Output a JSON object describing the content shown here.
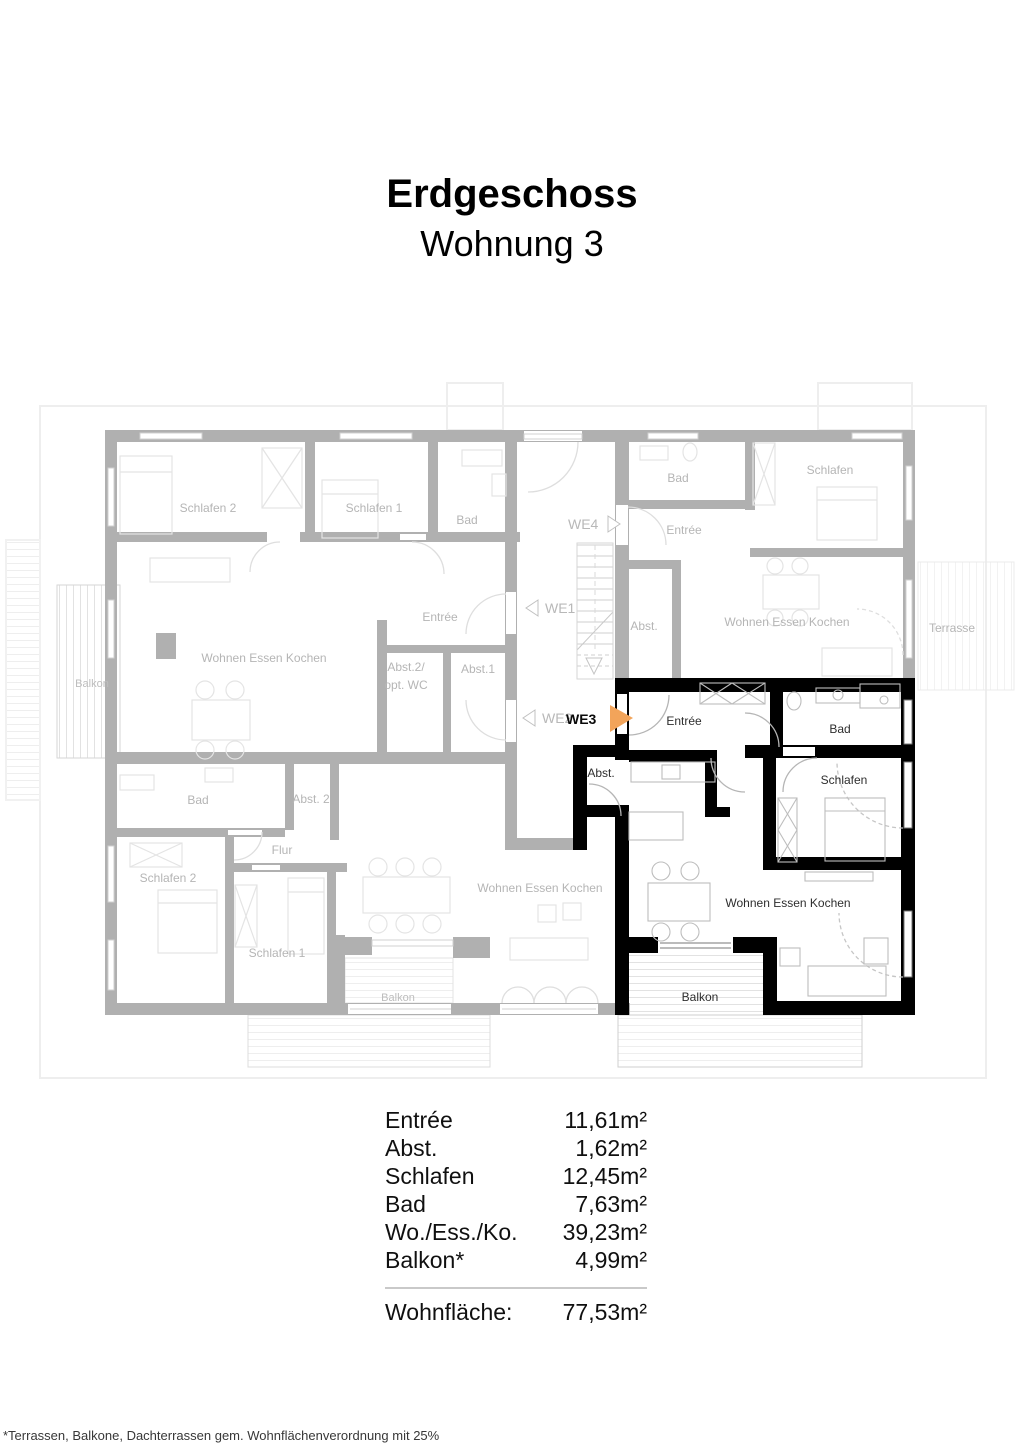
{
  "title": {
    "heading": "Erdgeschoss",
    "subheading": "Wohnung 3"
  },
  "colors": {
    "highlight_wall": "#000000",
    "inactive_wall": "#b0b0b0",
    "inactive_label": "#b5b5b5",
    "active_label": "#2e2e2e",
    "marker_arrow_active": "#f2a45a",
    "divider": "#c9c9c9"
  },
  "apartments": {
    "we1": {
      "marker": "WE1",
      "rooms": [
        "Schlafen 2",
        "Schlafen 1",
        "Bad",
        "Entrée",
        "Wohnen Essen Kochen",
        "Abst.2/",
        "opt. WC",
        "Abst.1",
        "Balkon"
      ]
    },
    "we2": {
      "marker": "WE2",
      "rooms": [
        "Bad",
        "Abst. 2",
        "Flur",
        "Schlafen 2",
        "Schlafen 1",
        "Wohnen Essen Kochen",
        "Balkon"
      ]
    },
    "we3": {
      "marker": "WE3",
      "rooms": [
        "Entrée",
        "Bad",
        "Abst.",
        "Schlafen",
        "Wohnen Essen Kochen",
        "Balkon"
      ]
    },
    "we4": {
      "marker": "WE4",
      "rooms": [
        "Bad",
        "Entrée",
        "Schlafen",
        "Abst.",
        "Wohnen Essen Kochen",
        "Terrasse"
      ]
    }
  },
  "area_table": {
    "rows": [
      {
        "label": "Entrée",
        "value": "11,61m²"
      },
      {
        "label": "Abst.",
        "value": "1,62m²"
      },
      {
        "label": "Schlafen",
        "value": "12,45m²"
      },
      {
        "label": "Bad",
        "value": "7,63m²"
      },
      {
        "label": "Wo./Ess./Ko.",
        "value": "39,23m²"
      },
      {
        "label": "Balkon*",
        "value": "4,99m²"
      }
    ],
    "total_label": "Wohnfläche:",
    "total_value": "77,53m²"
  },
  "footnote": "*Terrassen, Balkone, Dachterrassen gem. Wohnflächenverordnung mit 25%"
}
